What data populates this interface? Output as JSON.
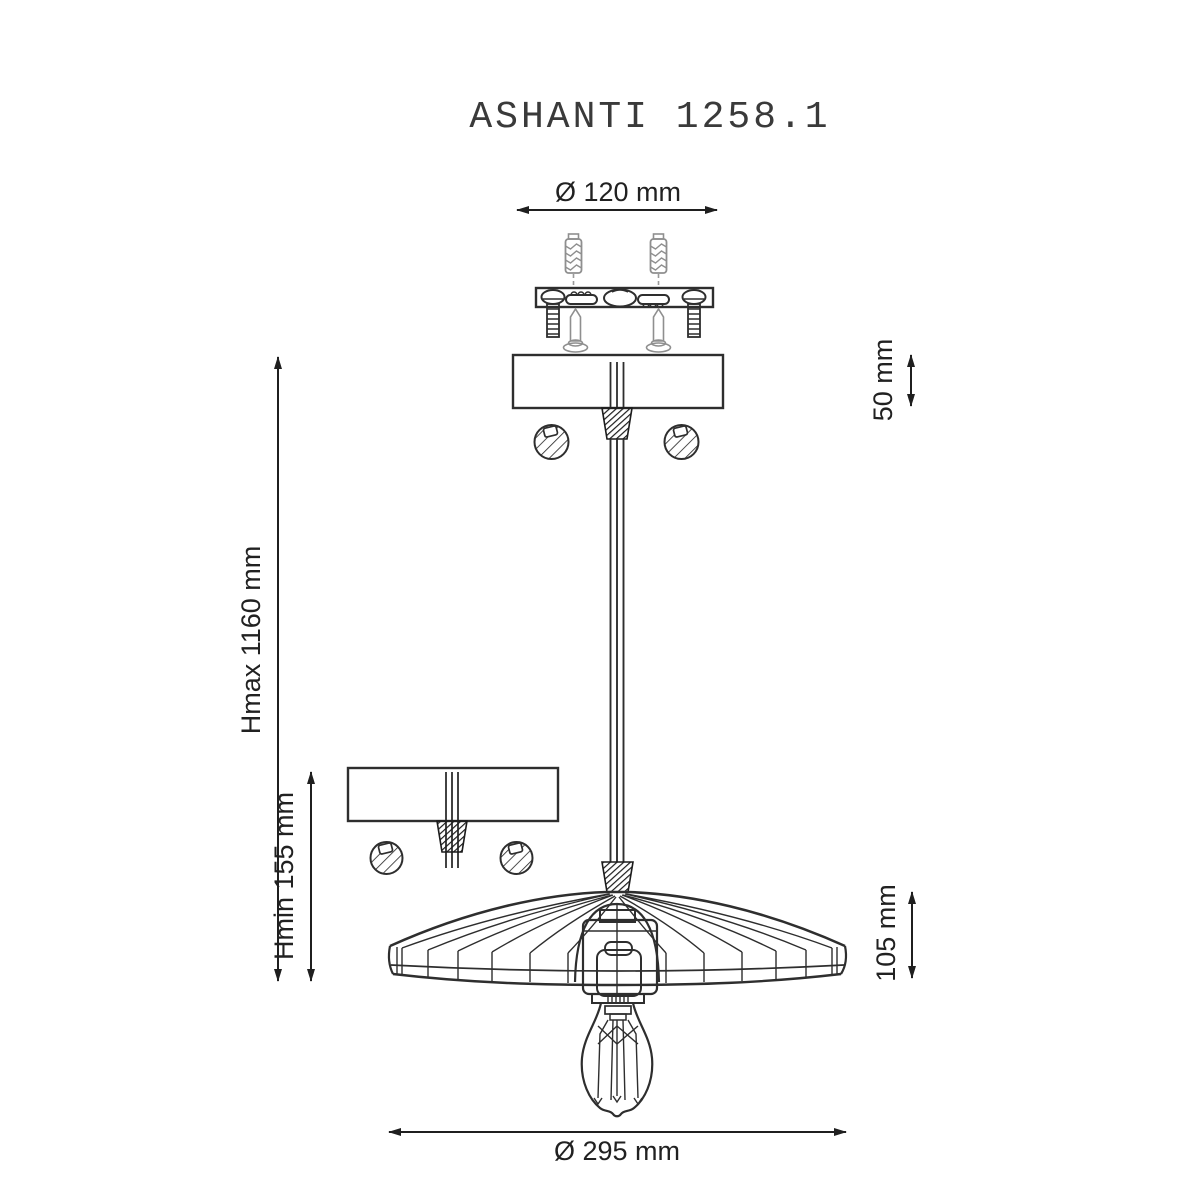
{
  "title": "ASHANTI 1258.1",
  "colors": {
    "line": "#2e2e2e",
    "hardware_gray": "#8f8f8f",
    "text": "#212121",
    "background": "#ffffff"
  },
  "dimensions": {
    "canopy_diameter": {
      "label": "Ø 120 mm"
    },
    "canopy_height": {
      "label": "50 mm"
    },
    "height_max": {
      "label": "Hmax 1160 mm"
    },
    "height_min": {
      "label": "Hmin 155 mm"
    },
    "shade_height": {
      "label": "105 mm"
    },
    "shade_diameter": {
      "label": "Ø 295 mm"
    }
  },
  "parts": {
    "wall_plugs": "wall plug anchors",
    "mounting_bracket": "ceiling mounting bracket with bolts and screws",
    "canopy": "ceiling canopy with cable grip and fixing nuts",
    "canopy_min": "canopy shown at minimum height",
    "cable": "triple suspension cable",
    "shade": "ribbed umbrella lamp shade",
    "socket": "lamp socket",
    "bulb": "filament light bulb"
  }
}
